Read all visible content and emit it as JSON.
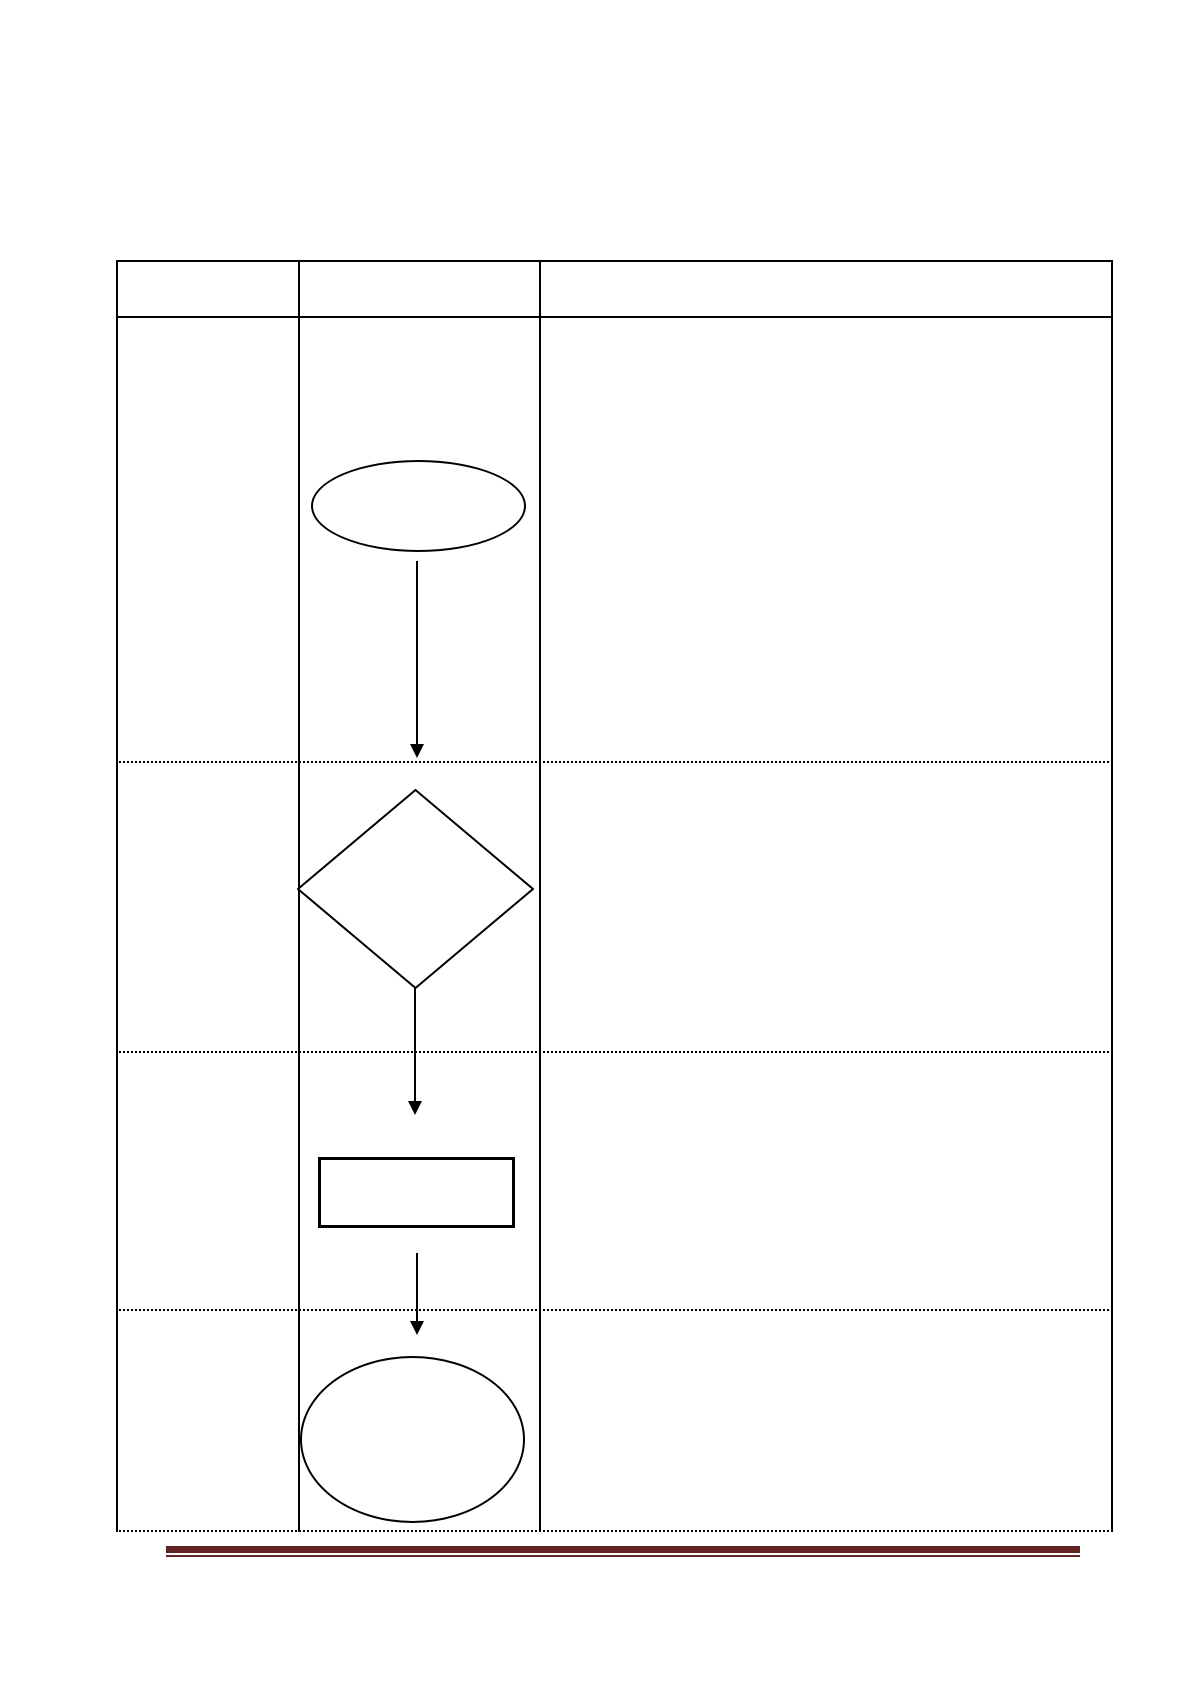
{
  "page": {
    "type": "document-page",
    "background_color": "#ffffff",
    "visible_text": []
  },
  "table": {
    "column_count": 3,
    "header_row": {
      "cells": [
        "",
        "",
        ""
      ]
    },
    "body_rows": [
      {
        "cells": [
          "",
          "",
          ""
        ]
      },
      {
        "cells": [
          "",
          "",
          ""
        ]
      },
      {
        "cells": [
          "",
          "",
          ""
        ]
      },
      {
        "cells": [
          "",
          "",
          ""
        ]
      }
    ],
    "border_color": "#000000",
    "outer_and_column_border_style": "solid",
    "row_divider_style": "dotted"
  },
  "flowchart": {
    "located_in_column": 2,
    "stroke_color": "#000000",
    "fill_color": "#ffffff",
    "nodes": [
      {
        "id": "start",
        "shape": "ellipse",
        "kind": "terminator",
        "label": "",
        "row": 1
      },
      {
        "id": "decision",
        "shape": "diamond",
        "kind": "decision",
        "label": "",
        "row": 2
      },
      {
        "id": "process",
        "shape": "rectangle",
        "kind": "process",
        "label": "",
        "row": 3
      },
      {
        "id": "end",
        "shape": "ellipse",
        "kind": "terminator",
        "label": "",
        "row": 4
      }
    ],
    "connectors": [
      {
        "from": "start",
        "to": "decision",
        "style": "straight-arrow-down"
      },
      {
        "from": "decision",
        "to": "process",
        "style": "straight-arrow-down"
      },
      {
        "from": "process",
        "to": "end",
        "style": "straight-arrow-down"
      }
    ]
  },
  "footer": {
    "decoration": "thick-thin-horizontal-rule",
    "rule_color": "#622423"
  }
}
